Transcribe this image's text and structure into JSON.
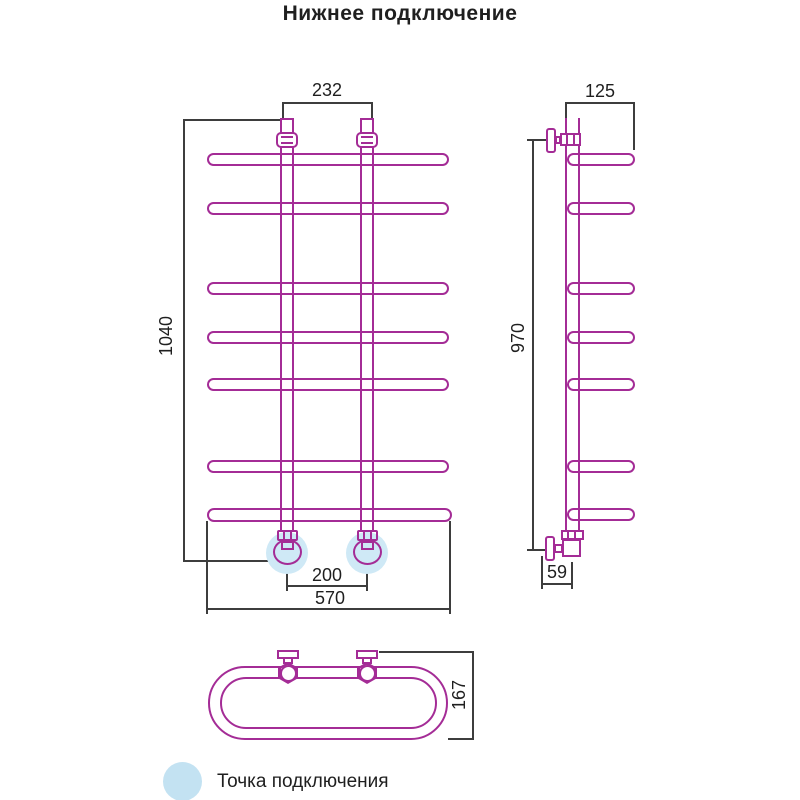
{
  "title": "Нижнее подключение",
  "dimensions": {
    "front_top_width": "232",
    "front_height": "1040",
    "front_connection_spacing": "200",
    "front_width": "570",
    "side_top_depth": "125",
    "side_height": "970",
    "side_bottom_offset": "59",
    "top_view_depth": "167"
  },
  "legend": {
    "label": "Точка подключения"
  },
  "colors": {
    "pipe": "#a42c96",
    "dimension_line": "#3d3d3d",
    "text": "#1f1f1f",
    "connection_highlight": "#cfe9f6",
    "legend_marker": "#c3e2f2"
  }
}
